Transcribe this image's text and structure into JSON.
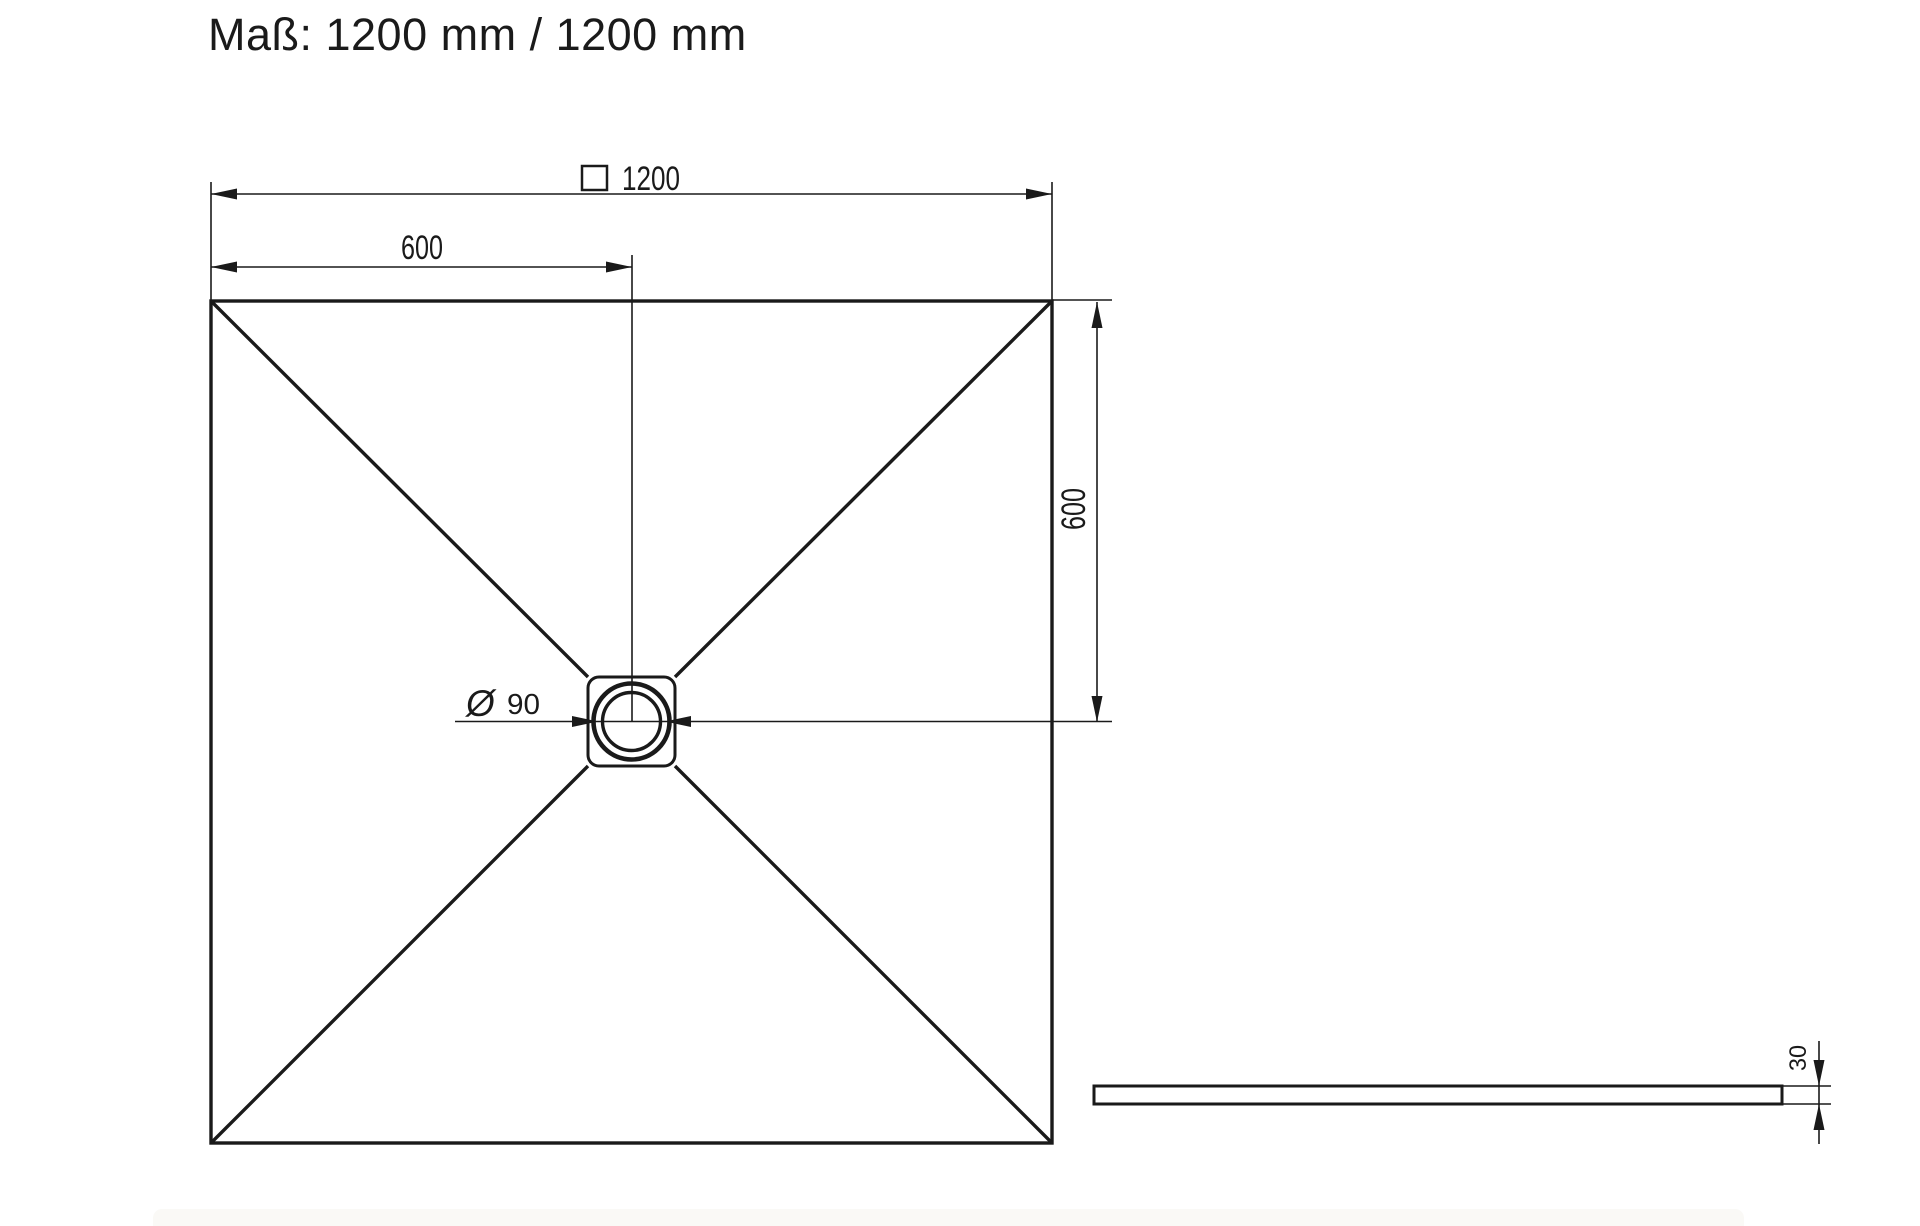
{
  "title": "Maß: 1200 mm / 1200 mm",
  "colors": {
    "line": "#1a1a1a",
    "background": "#ffffff",
    "bottom_bar": "#faf9f6"
  },
  "dimensions": {
    "overall_width": {
      "symbol": "□",
      "symbol_icon": "square-outline-icon",
      "value": "1200"
    },
    "center_offset_horizontal": {
      "value": "600"
    },
    "center_offset_vertical": {
      "value": "600"
    },
    "drain_diameter": {
      "symbol": "Ø",
      "value": "90"
    },
    "tray_thickness": {
      "value": "30"
    }
  }
}
